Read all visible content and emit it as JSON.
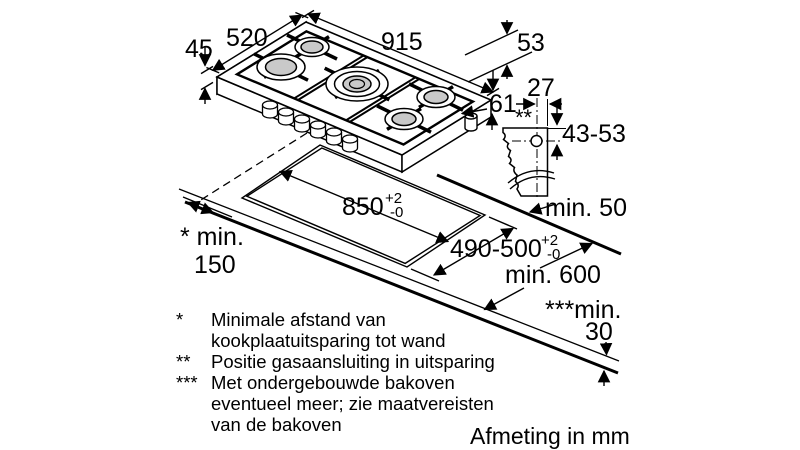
{
  "drawing": {
    "caption": "Afmeting in mm",
    "colors": {
      "line": "#000000",
      "burner_fill": "#c9c9c9",
      "background": "#ffffff"
    },
    "dims": {
      "height_left": "45",
      "depth_total": "520",
      "width_total": "915",
      "height_right": "53",
      "gas_offset_right": "61",
      "gas_offset_edge": "27",
      "gas_marker": "**",
      "gas_depth": "43-53",
      "min_rear": "min. 50",
      "cutout_length": "850",
      "cutout_length_tol_plus": "+2",
      "cutout_length_tol_minus": "-0",
      "cutout_depth": "490-500",
      "cutout_depth_tol_plus": "+2",
      "cutout_depth_tol_minus": "-0",
      "min_side_label": "* min.",
      "min_side_value": "150",
      "min_worktop_depth": "min. 600",
      "min_oven_label": "***min.",
      "min_oven_value": "30"
    },
    "footnotes": [
      {
        "marker": "*",
        "lines": [
          "Minimale afstand van",
          "kookplaatuitsparing tot wand"
        ]
      },
      {
        "marker": "**",
        "lines": [
          "Positie gasaansluiting in uitsparing"
        ]
      },
      {
        "marker": "***",
        "lines": [
          "Met ondergebouwde bakoven",
          "eventueel meer; zie maatvereisten",
          "van de bakoven"
        ]
      }
    ]
  }
}
